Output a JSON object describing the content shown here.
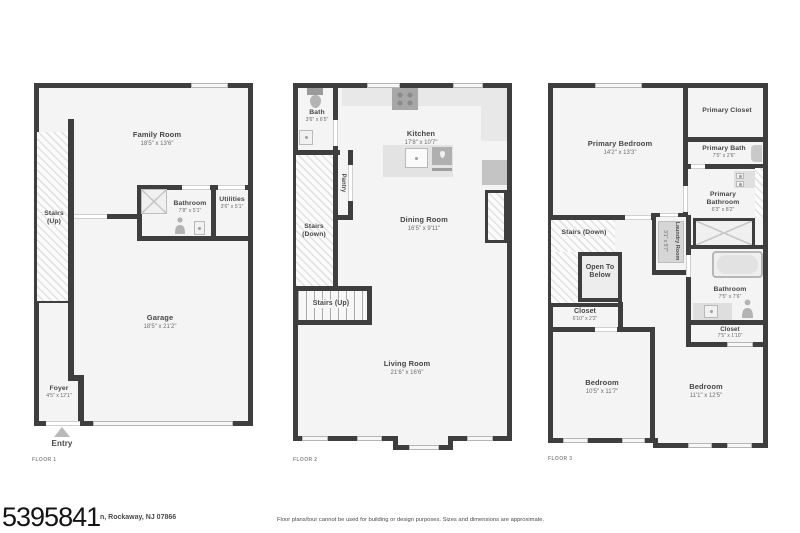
{
  "meta": {
    "watermark_id": "5395841",
    "address_visible": "n, Rockaway, NJ 07866",
    "disclaimer": "Floor plans/tour cannot be used for building or design purposes. Sizes and dimensions are approximate.",
    "entry_label": "Entry"
  },
  "colors": {
    "wall": "#3e3e3e",
    "floor_fill": "#f4f4f4",
    "fixture": "#e8e8e8",
    "hatch_line": "#e2e2e2",
    "text": "#474747"
  },
  "floors": [
    {
      "label": "FLOOR 1",
      "rooms": {
        "family": {
          "name": "Family Room",
          "dims": "18'5\" x 13'6\""
        },
        "stairs": {
          "name": "Stairs",
          "name2": "(Up)"
        },
        "bathroom": {
          "name": "Bathroom",
          "dims": "7'8\" x 5'1\""
        },
        "utilities": {
          "name": "Utilities",
          "dims": "3'6\" x 5'1\""
        },
        "garage": {
          "name": "Garage",
          "dims": "18'5\" x 21'2\""
        },
        "foyer": {
          "name": "Foyer",
          "dims": "4'5\" x 12'1\""
        }
      }
    },
    {
      "label": "FLOOR 2",
      "rooms": {
        "bath": {
          "name": "Bath",
          "dims": "3'6\" x 6'5\""
        },
        "kitchen": {
          "name": "Kitchen",
          "dims": "17'8\" x 10'7\""
        },
        "pantry": {
          "name": "Pantry"
        },
        "stairs_down": {
          "name": "Stairs",
          "name2": "(Down)"
        },
        "dining": {
          "name": "Dining Room",
          "dims": "16'5\" x 9'11\""
        },
        "stairs_up": {
          "name": "Stairs (Up)"
        },
        "living": {
          "name": "Living Room",
          "dims": "21'6\" x 16'6\""
        }
      }
    },
    {
      "label": "FLOOR 3",
      "rooms": {
        "primary_bedroom": {
          "name": "Primary Bedroom",
          "dims": "14'2\" x 13'3\""
        },
        "primary_closet": {
          "name": "Primary Closet"
        },
        "primary_bath": {
          "name": "Primary Bath",
          "dims": "7'5\" x 2'6\""
        },
        "primary_bathroom": {
          "name": "Primary",
          "name2": "Bathroom",
          "dims": "6'3\" x 8'2\""
        },
        "stairs_down": {
          "name": "Stairs (Down)"
        },
        "laundry": {
          "name": "Laundry Room",
          "dims": "3'1\" x 5'7\""
        },
        "open_below": {
          "name": "Open To",
          "name2": "Below"
        },
        "closet_left": {
          "name": "Closet",
          "dims": "6'10\" x 2'2\""
        },
        "bathroom": {
          "name": "Bathroom",
          "dims": "7'5\" x 7'6\""
        },
        "closet_right": {
          "name": "Closet",
          "dims": "7'5\" x 1'10\""
        },
        "bedroom_left": {
          "name": "Bedroom",
          "dims": "10'5\" x 11'7\""
        },
        "bedroom_right": {
          "name": "Bedroom",
          "dims": "11'1\" x 12'5\""
        }
      }
    }
  ]
}
